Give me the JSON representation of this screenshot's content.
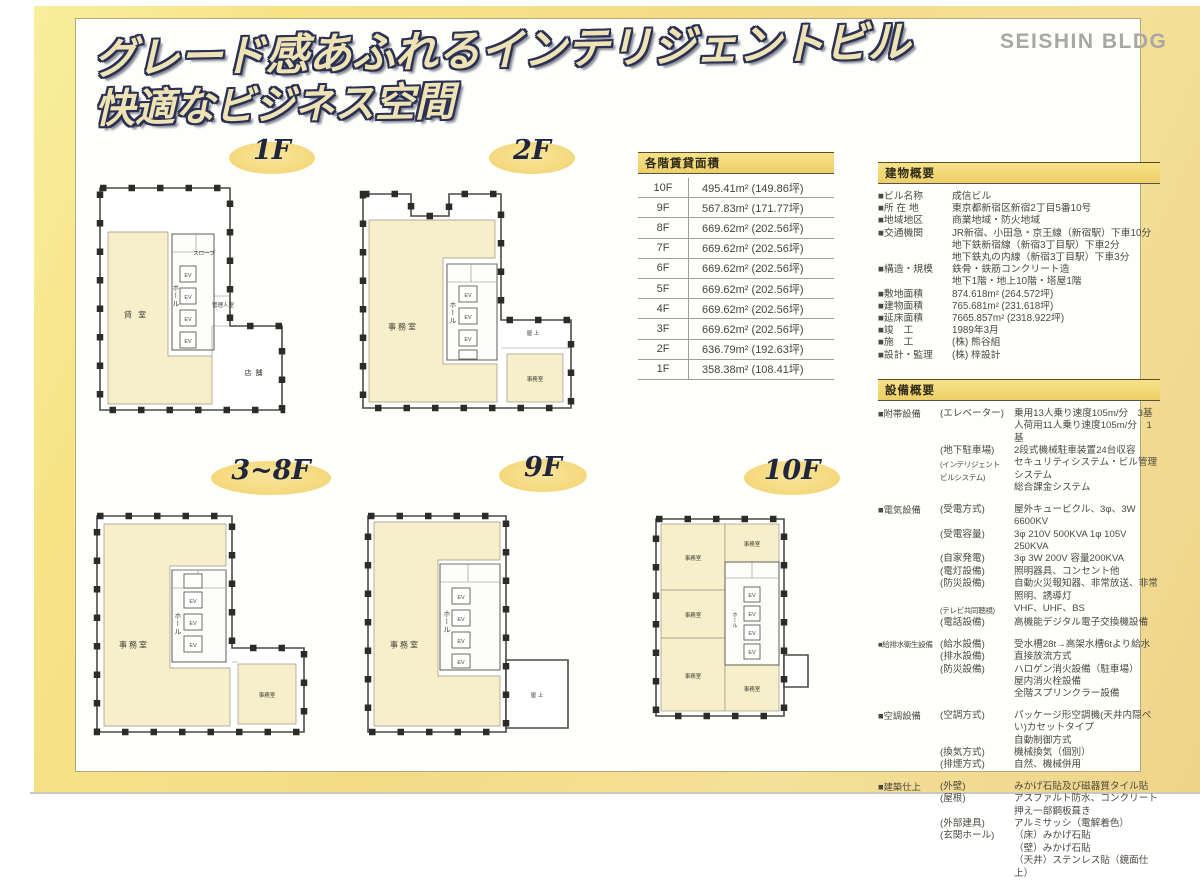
{
  "shared": {
    "ev_label": "EV"
  },
  "header": {
    "title_line1": "グレード感あふれるインテリジェントビル",
    "title_line2": "快適なビジネス空間",
    "brand": "SEISHIN BLDG"
  },
  "area_table": {
    "title": "各階賃貸面積",
    "rows": [
      {
        "floor": "10F",
        "area": "495.41m² (149.86坪)"
      },
      {
        "floor": "9F",
        "area": "567.83m² (171.77坪)"
      },
      {
        "floor": "8F",
        "area": "669.62m² (202.56坪)"
      },
      {
        "floor": "7F",
        "area": "669.62m² (202.56坪)"
      },
      {
        "floor": "6F",
        "area": "669.62m² (202.56坪)"
      },
      {
        "floor": "5F",
        "area": "669.62m² (202.56坪)"
      },
      {
        "floor": "4F",
        "area": "669.62m² (202.56坪)"
      },
      {
        "floor": "3F",
        "area": "669.62m² (202.56坪)"
      },
      {
        "floor": "2F",
        "area": "636.79m² (192.63坪)"
      },
      {
        "floor": "1F",
        "area": "358.38m² (108.41坪)"
      }
    ]
  },
  "building_overview": {
    "title": "建物概要",
    "rows": [
      {
        "label": "■ビル名称",
        "value": "成信ビル"
      },
      {
        "label": "■所 在 地",
        "value": "東京都新宿区新宿2丁目5番10号"
      },
      {
        "label": "■地域地区",
        "value": "商業地域・防火地域"
      },
      {
        "label": "■交通機関",
        "value": "JR新宿、小田急・京王線（新宿駅）下車10分\n地下鉄新宿線（新宿3丁目駅）下車2分\n地下鉄丸の内線（新宿3丁目駅）下車3分"
      },
      {
        "label": "■構造・規模",
        "value": "鉄骨・鉄筋コンクリート造\n地下1階・地上10階・塔屋1階"
      },
      {
        "label": "■敷地面積",
        "value": "874.618m² (264.572坪)"
      },
      {
        "label": "■建物面積",
        "value": "765.681m² (231.618坪)"
      },
      {
        "label": "■延床面積",
        "value": "7665.857m² (2318.922坪)"
      },
      {
        "label": "■竣　工",
        "value": "1989年3月"
      },
      {
        "label": "■施　工",
        "value": "(株) 熊谷組"
      },
      {
        "label": "■設計・監理",
        "value": "(株) 梓設計"
      }
    ]
  },
  "facility_overview": {
    "title": "設備概要",
    "groups": [
      {
        "label": "■附帯設備",
        "items": [
          {
            "sub": "(エレベーター)",
            "value": "乗用13人乗り速度105m/分　3基\n人荷用11人乗り速度105m/分　1基"
          },
          {
            "sub": "(地下駐車場)",
            "value": "2段式機械駐車装置24台収容"
          },
          {
            "sub": "(インテリジェント\nビルシステム)",
            "value": "セキュリティシステム・ビル管理システム\n総合課金システム"
          }
        ]
      },
      {
        "label": "■電気設備",
        "items": [
          {
            "sub": "(受電方式)",
            "value": "屋外キュービクル、3φ、3W 6600KV"
          },
          {
            "sub": "(受電容量)",
            "value": "3φ 210V 500KVA 1φ 105V 250KVA"
          },
          {
            "sub": "(自家発電)",
            "value": "3φ 3W 200V 容量200KVA"
          },
          {
            "sub": "(電灯設備)",
            "value": "照明器具、コンセント他"
          },
          {
            "sub": "(防災設備)",
            "value": "自動火災報知器、非常放送、非常照明、誘導灯"
          },
          {
            "sub": "(テレビ共同聴視)",
            "value": "VHF、UHF、BS"
          },
          {
            "sub": "(電話設備)",
            "value": "高機能デジタル電子交換機設備"
          }
        ]
      },
      {
        "label": "■給排水衛生設備",
        "items": [
          {
            "sub": "(給水設備)",
            "value": "受水槽28t→高架水槽6tより給水"
          },
          {
            "sub": "(排水設備)",
            "value": "直接放流方式"
          },
          {
            "sub": "(防災設備)",
            "value": "ハロゲン消火設備（駐車場）\n屋内消火栓設備\n全階スプリンクラー設備"
          }
        ]
      },
      {
        "label": "■空調設備",
        "items": [
          {
            "sub": "(空調方式)",
            "value": "パッケージ形空調機(天井内隠ぺい)カセットタイプ\n自動制御方式"
          },
          {
            "sub": "(換気方式)",
            "value": "機械換気（個別）"
          },
          {
            "sub": "(排煙方式)",
            "value": "自然、機械併用"
          }
        ]
      },
      {
        "label": "■建築仕上",
        "items": [
          {
            "sub": "(外壁)",
            "value": "みかげ石貼及び磁器質タイル貼"
          },
          {
            "sub": "(屋根)",
            "value": "アスファルト防水、コンクリート押え一部鋼板葺き"
          },
          {
            "sub": "(外部建具)",
            "value": "アルミサッシ（電解着色）"
          },
          {
            "sub": "(玄関ホール)",
            "value": "（床）みかげ石貼\n（壁）みかげ石貼\n（天井）ステンレス貼（鏡面仕上）"
          }
        ]
      }
    ]
  },
  "floors": [
    {
      "label": "1F",
      "rooms": {
        "main": "貸 室",
        "hall": "ホール",
        "slope": "スロープ",
        "manager": "管理人室",
        "shop": "店 舗"
      }
    },
    {
      "label": "2F",
      "rooms": {
        "main": "事務室",
        "hall": "ホール",
        "roof": "屋 上",
        "office2": "事務室"
      }
    },
    {
      "label": "3~8F",
      "rooms": {
        "main": "事務室",
        "hall": "ホール",
        "office2": "事務室"
      }
    },
    {
      "label": "9F",
      "rooms": {
        "main": "事務室",
        "hall": "ホール",
        "roof": "屋 上"
      }
    },
    {
      "label": "10F",
      "rooms": {
        "o1": "事務室",
        "o2": "事務室",
        "o3": "事務室",
        "o4": "事務室",
        "o5": "事務室",
        "hall": "ホール"
      }
    }
  ]
}
